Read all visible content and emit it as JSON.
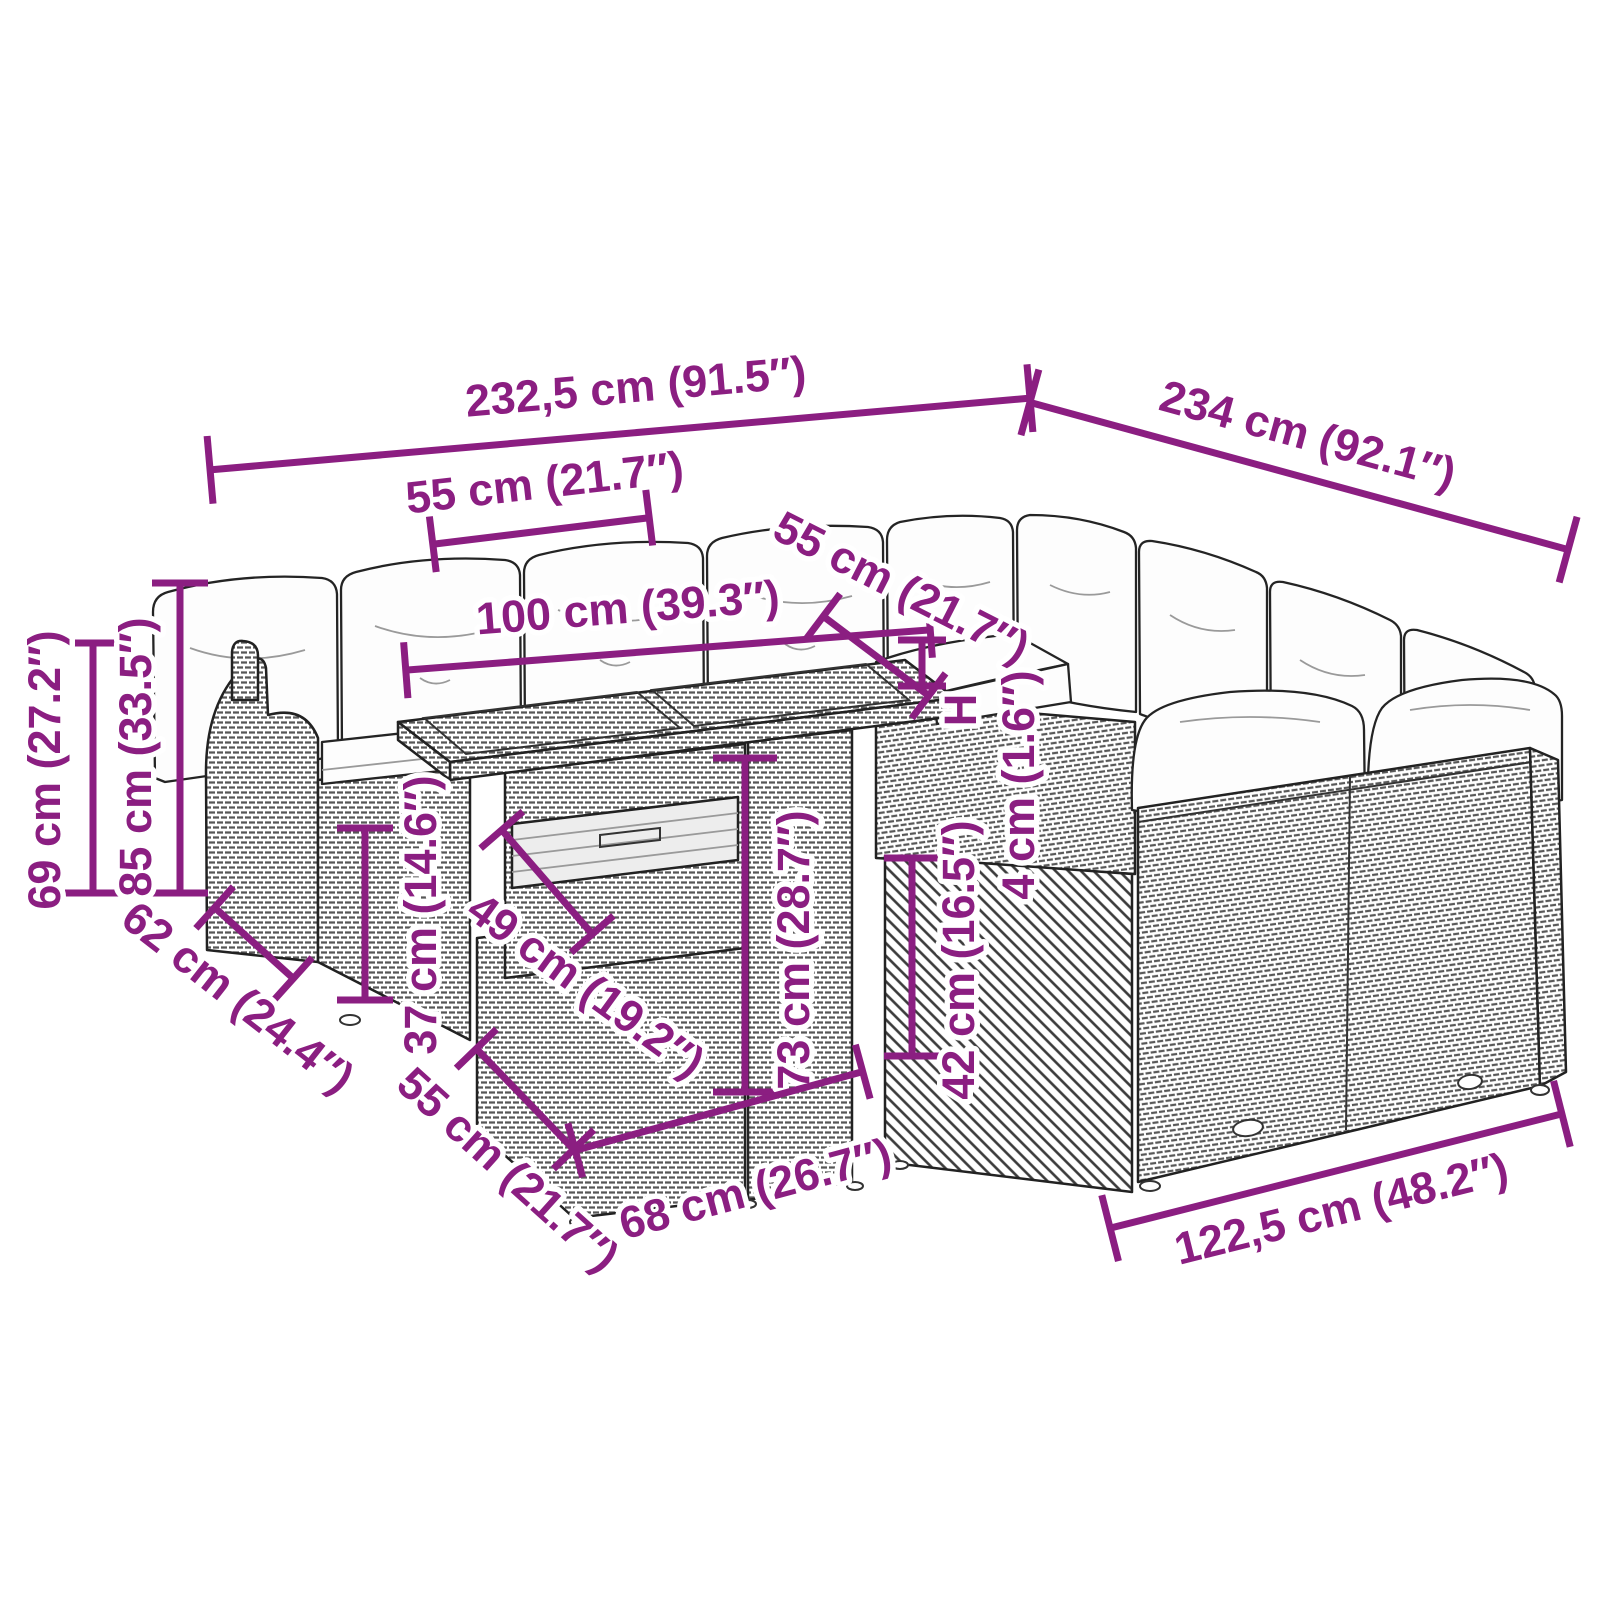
{
  "diagram": {
    "type": "product-dimension-diagram",
    "subject": "rattan garden lounge set with bar table",
    "colors": {
      "accent": "#8b1e81",
      "outline": "#222222",
      "weave": "#585858",
      "cushion": "#fdfdfd"
    },
    "dims": {
      "overall_width": "232,5 cm (91.5″)",
      "overall_depth": "234 cm (92.1″)",
      "backrest_module_width": "55 cm (21.7″)",
      "tabletop_length": "100 cm (39.3″)",
      "right_module_width": "55 cm (21.7″)",
      "armrest_height": "69 cm (27.2″)",
      "total_height": "85 cm (33.5″)",
      "armrest_depth": "62 cm (24.4″)",
      "base_height": "37 cm (14.6″)",
      "tabletop_depth": "49 cm (19.2″)",
      "table_height": "73 cm (28.7″)",
      "module_depth": "55 cm (21.7″)",
      "table_base_width": "68 cm (26.7″)",
      "seat_height": "42 cm (16.5″)",
      "cushion_symbol": "H",
      "cushion_thickness": "4 cm (1.6″)",
      "right_section_length": "122,5 cm (48.2″)"
    }
  }
}
